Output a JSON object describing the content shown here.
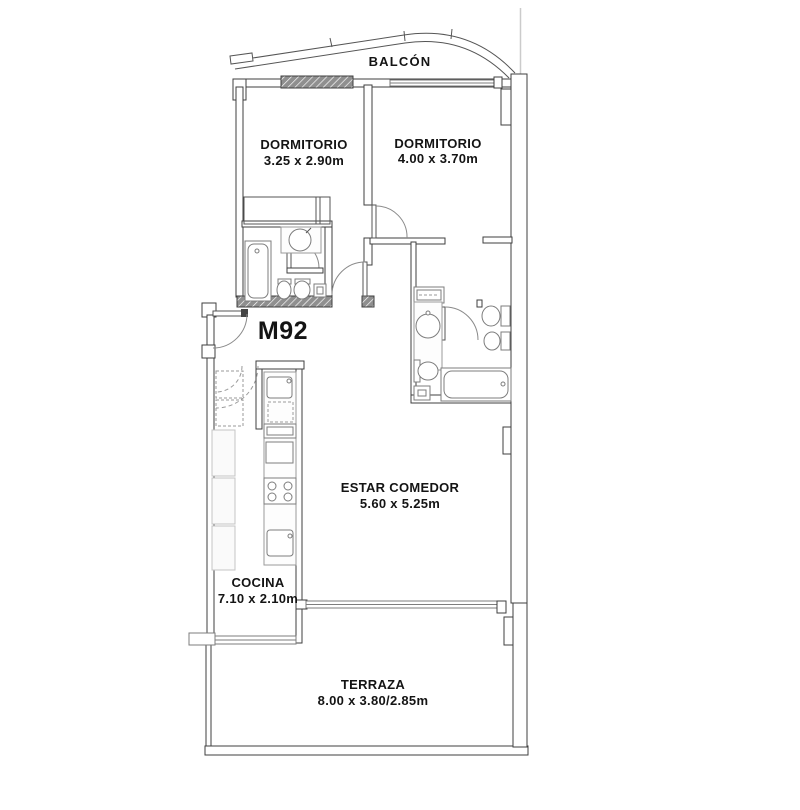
{
  "meta": {
    "drawing_type": "apartment floor plan",
    "unit_label": "M92"
  },
  "labels": {
    "unit": "M92",
    "balcony": {
      "name": "BALCÓN"
    },
    "bedroom1": {
      "name": "DORMITORIO",
      "dims": "3.25 x 2.90m"
    },
    "bedroom2": {
      "name": "DORMITORIO",
      "dims": "4.00 x 3.70m"
    },
    "living": {
      "name": "ESTAR COMEDOR",
      "dims": "5.60 x 5.25m"
    },
    "kitchen": {
      "name": "COCINA",
      "dims": "7.10 x 2.10m"
    },
    "terrace": {
      "name": "TERRAZA",
      "dims": "8.00 x 3.80/2.85m"
    }
  },
  "fixtures": [
    "bathtub",
    "washbasin",
    "toilet",
    "bidet",
    "shower-drain",
    "kitchen-sink",
    "oven",
    "cooktop",
    "refrigerator-cabinet",
    "wardrobe",
    "closet",
    "washing-machine"
  ],
  "colors": {
    "background": "#ffffff",
    "wall_line": "#3f3f3f",
    "fixture_line": "#7d7d7d",
    "hatch_fill": "#8f8f8f",
    "faint_guide_line": "#cbcbcb",
    "text": "#141414"
  }
}
